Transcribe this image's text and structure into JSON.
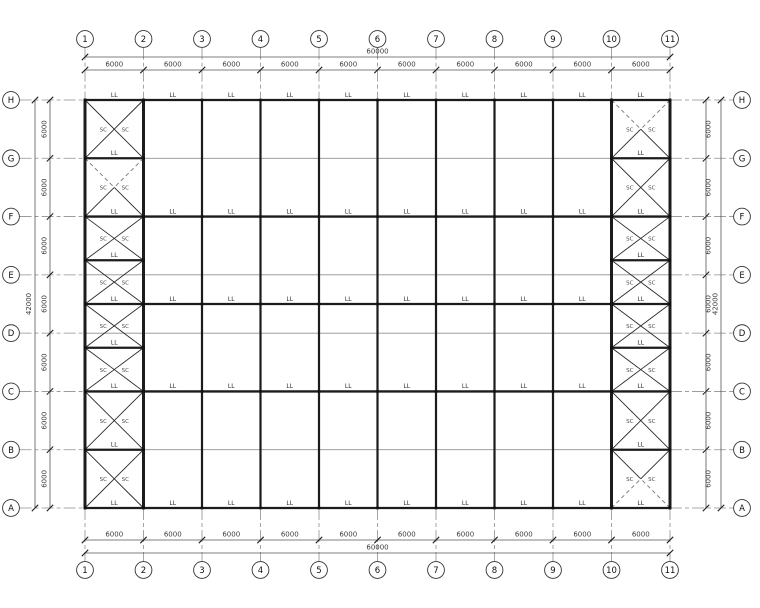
{
  "drawing": {
    "type": "roof-bracing-plan",
    "grid_columns": {
      "bubbles": [
        "1",
        "2",
        "3",
        "4",
        "5",
        "6",
        "7",
        "8",
        "9",
        "10",
        "11"
      ],
      "bay_dims": [
        "6000",
        "6000",
        "6000",
        "6000",
        "6000",
        "6000",
        "6000",
        "6000",
        "6000",
        "6000"
      ],
      "total_dim": "60000"
    },
    "grid_rows": {
      "bubbles": [
        "H",
        "G",
        "F",
        "E",
        "D",
        "C",
        "B",
        "A"
      ],
      "bay_dims": [
        "6000",
        "6000",
        "6000",
        "6000",
        "6000",
        "6000",
        "6000"
      ],
      "total_dim": "42000"
    },
    "member_labels": {
      "tie_beam": "LL",
      "brace": "SC"
    },
    "braced_bays": [
      {
        "left_col": "1",
        "right_col": "2",
        "panel_dashes": [
          "none",
          "top",
          "none",
          "none",
          "none",
          "none",
          "none",
          "none"
        ]
      },
      {
        "left_col": "10",
        "right_col": "11",
        "panel_dashes": [
          "top",
          "none",
          "none",
          "none",
          "none",
          "none",
          "none",
          "bottom"
        ]
      }
    ],
    "colors": {
      "line": "#1c1c1c",
      "thin_line": "#8f8f8f",
      "text": "#3c3c3c",
      "background": "#ffffff"
    }
  }
}
